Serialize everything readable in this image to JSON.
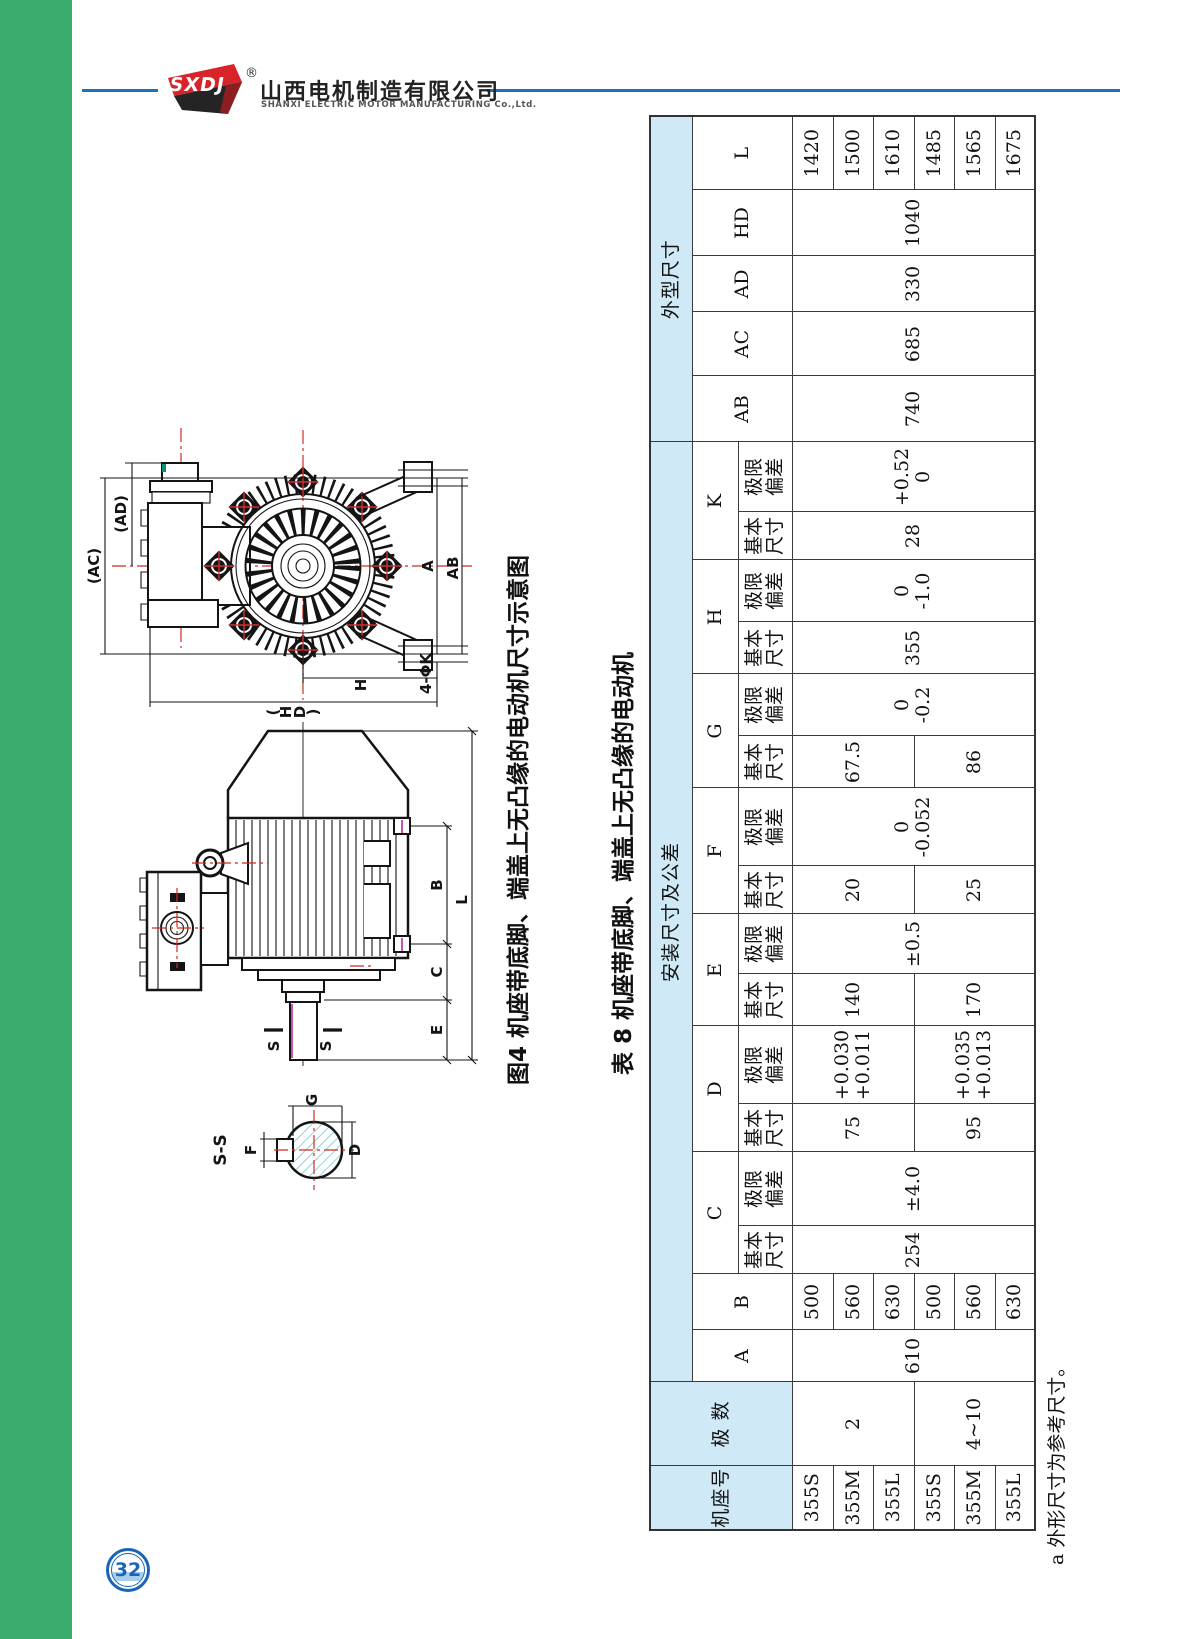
{
  "page": {
    "number": "32"
  },
  "header": {
    "logo_text": "SXDJ",
    "registered": "®",
    "company_cn": "山西电机制造有限公司",
    "company_en": "SHANXI ELECTRIC MOTOR MANUFACTURING Co.,Ltd.",
    "accent_blue": "#1d6fc0",
    "sidebar_green": "#3bac6b"
  },
  "figure": {
    "caption": "图4 机座带底脚、端盖上无凸缘的电动机尺寸示意图",
    "labels": {
      "ac": "(AC)",
      "ad": "(AD)",
      "hd0": "(",
      "hd1": "H",
      "hd2": "D",
      "hd3": ")",
      "h": "H",
      "a": "A",
      "ab": "AB",
      "k4": "4-ΦK",
      "b": "B",
      "c": "C",
      "e": "E",
      "l": "L",
      "s": "S",
      "ss": "S-S",
      "f": "F",
      "g": "G",
      "d": "D"
    }
  },
  "table": {
    "caption": "表 8 机座带底脚、端盖上无凸缘的电动机",
    "footnote": "a 外形尺寸为参考尺寸。",
    "header_blue": "#cfe9f6",
    "groups": {
      "install": "安装尺寸及公差",
      "outline": "外型尺寸"
    },
    "headers": {
      "frame": "机座号",
      "poles": "极 数",
      "basic1": "基本",
      "basic2": "尺寸",
      "dev1": "极限",
      "dev2": "偏差",
      "A": "A",
      "B": "B",
      "C": "C",
      "D": "D",
      "E": "E",
      "F": "F",
      "G": "G",
      "H": "H",
      "K": "K",
      "AB": "AB",
      "AC": "AC",
      "AD": "AD",
      "HD": "HD",
      "L": "L"
    },
    "frames": [
      "355S",
      "355M",
      "355L",
      "355S",
      "355M",
      "355L"
    ],
    "poles2": "2",
    "poles410": "4~10",
    "A": "610",
    "B": [
      "500",
      "560",
      "630",
      "500",
      "560",
      "630"
    ],
    "Cb": "254",
    "Cd": "±4.0",
    "Db1": "75",
    "Dd1a": "+0.030",
    "Dd1b": "+0.011",
    "Db2": "95",
    "Dd2a": "+0.035",
    "Dd2b": "+0.013",
    "Eb1": "140",
    "Eb2": "170",
    "Ed": "±0.5",
    "Fb1": "20",
    "Fb2": "25",
    "Fda": "0",
    "Fdb": "-0.052",
    "Gb1": "67.5",
    "Gb2": "86",
    "Gda": "0",
    "Gdb": "-0.2",
    "Hb": "355",
    "Hda": "0",
    "Hdb": "-1.0",
    "Kb": "28",
    "Kda": "+0.52",
    "Kdb": "0",
    "AB": "740",
    "AC": "685",
    "AD": "330",
    "HD": "1040",
    "L": [
      "1420",
      "1500",
      "1610",
      "1485",
      "1565",
      "1675"
    ]
  }
}
